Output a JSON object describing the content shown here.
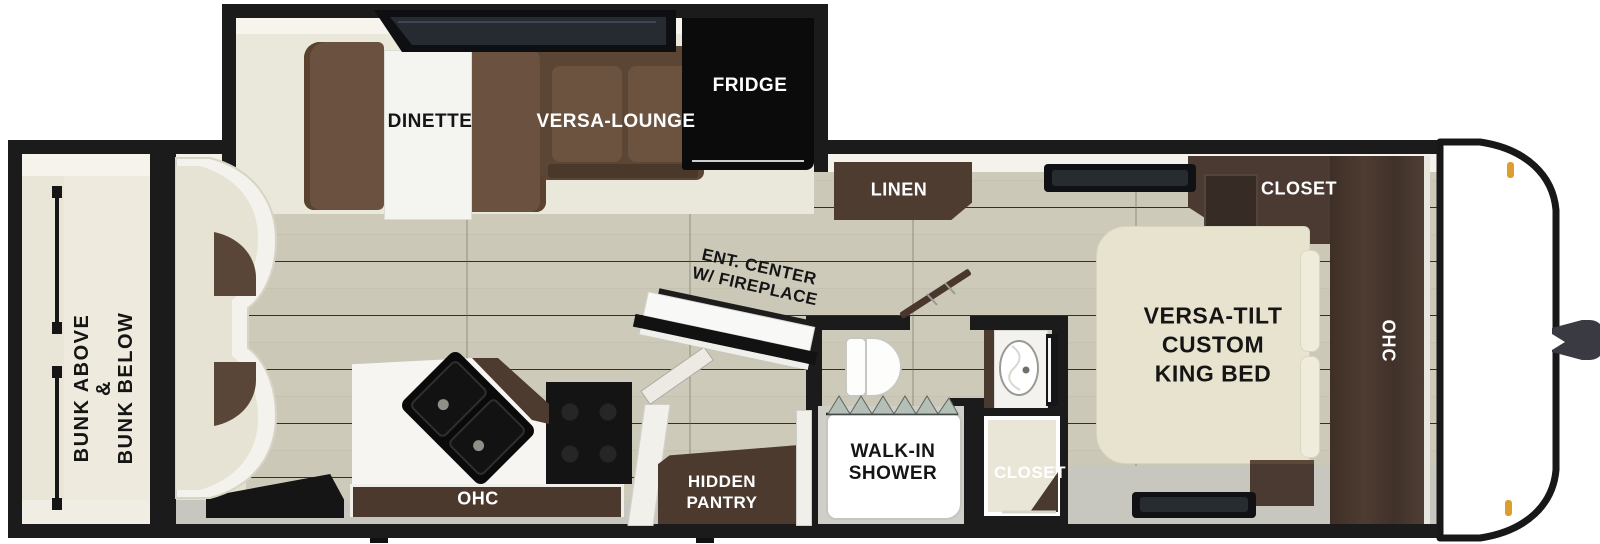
{
  "title": "Travel trailer floor plan",
  "colors": {
    "wall": "#1b1b1b",
    "floor_wood": "#cbc8b7",
    "interior_cream": "#eae7db",
    "sofa_brown": "#6a5140",
    "cabinet_brown": "#4b3a31",
    "bed_cream": "#e7e3cf",
    "fixture_white": "#ffffff",
    "marker_amber": "#dd9e2f"
  },
  "labels": {
    "bunk_room": {
      "line1": "BUNK ABOVE",
      "line2": "&",
      "line3": "BUNK BELOW"
    },
    "dinette": "DINETTE",
    "versa_lounge": "VERSA-LOUNGE",
    "fridge": "FRIDGE",
    "linen": "LINEN",
    "closet_bedroom": "CLOSET",
    "ent_center": {
      "line1": "ENT. CENTER",
      "line2": "W/ FIREPLACE"
    },
    "king_bed": {
      "line1": "VERSA-TILT",
      "line2": "CUSTOM",
      "line3": "KING BED"
    },
    "ohc_bedroom": "OHC",
    "ohc_kitchen": "OHC",
    "walk_in_shower": {
      "line1": "WALK-IN",
      "line2": "SHOWER"
    },
    "closet_bathroom": "CLOSET",
    "hidden_pantry": {
      "line1": "HIDDEN",
      "line2": "PANTRY"
    }
  }
}
